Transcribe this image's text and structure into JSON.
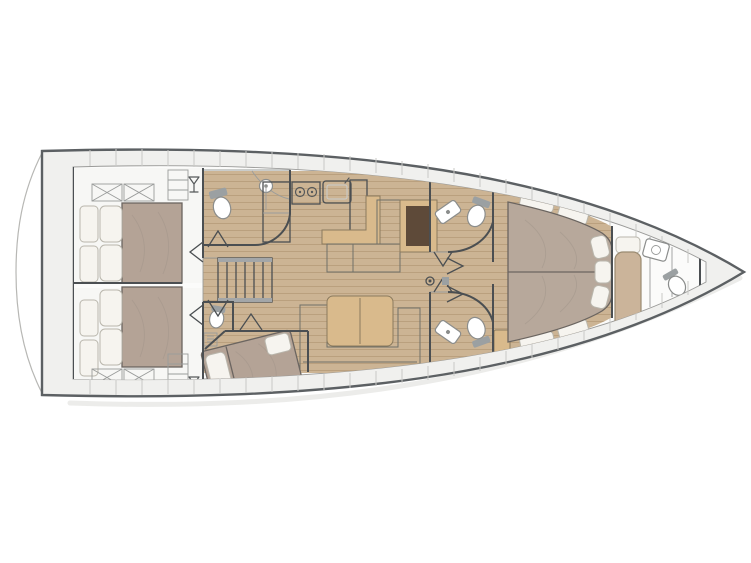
{
  "meta": {
    "description": "Top-down interior layout plan of a sailing yacht, bow pointing right, stern platform at left. No visible text in the drawing.",
    "orientation": "bow-right",
    "style": "architectural floor plan"
  },
  "colors": {
    "background": "#ffffff",
    "hull_outline": "#5c6063",
    "deck": "#f0f0ee",
    "interior": "#fbfbfa",
    "room_white": "#f7f7f5",
    "wall": "#4b4f52",
    "wood_floor": "#ccb494",
    "plank_line": "#b89e7c",
    "stairs_wood": "#c9ae8a",
    "mattress": "#b4a396",
    "mattress_fwd": "#b7a89b",
    "pillow": "#f6f4ef",
    "sofa": "#90918a",
    "table_wood": "#d9ba8c",
    "chart_table": "#5e4a39",
    "counter": "#a3a6a8",
    "appliance": "#9b9fa1",
    "sink": "#6e7478",
    "tank": "#9ba0a2",
    "crew_berth": "#cbb49a",
    "white_fixture": "#ffffff",
    "shadow": "#d4d4d1",
    "transom": "#b7b7b4"
  },
  "rooms": [
    {
      "id": "aft-cabin-port",
      "name": "Aft double cabin (port)"
    },
    {
      "id": "aft-cabin-starboard",
      "name": "Aft double cabin (starboard)"
    },
    {
      "id": "aft-head",
      "name": "Aft head with toilet and basin"
    },
    {
      "id": "aft-head-starboard",
      "name": "Aft shower head (starboard)"
    },
    {
      "id": "mid-cabin",
      "name": "Third cabin with angled double berth"
    },
    {
      "id": "companionway",
      "name": "Companionway steps"
    },
    {
      "id": "galley",
      "name": "Galley with fridge, stove and sink"
    },
    {
      "id": "nav-dinette",
      "name": "L-settee with chart table"
    },
    {
      "id": "salon",
      "name": "Salon with U-sofa and table"
    },
    {
      "id": "forward-head-port",
      "name": "Forward head (port)"
    },
    {
      "id": "forward-head-starboard",
      "name": "Forward head (starboard)"
    },
    {
      "id": "forward-cabin",
      "name": "Forward owner cabin with island bed"
    },
    {
      "id": "bow-crew-cabin",
      "name": "Bow crew compartment with berth, basin and toilet"
    },
    {
      "id": "anchor-locker",
      "name": "Bow anchor locker"
    }
  ],
  "fixtures": [
    "deck-hatch",
    "wine-glass-locker",
    "toilet",
    "wash-basin",
    "shower-pan",
    "stove-two-burner",
    "galley-sink",
    "fridge",
    "mast-post",
    "door-bifold",
    "swim-platform"
  ]
}
